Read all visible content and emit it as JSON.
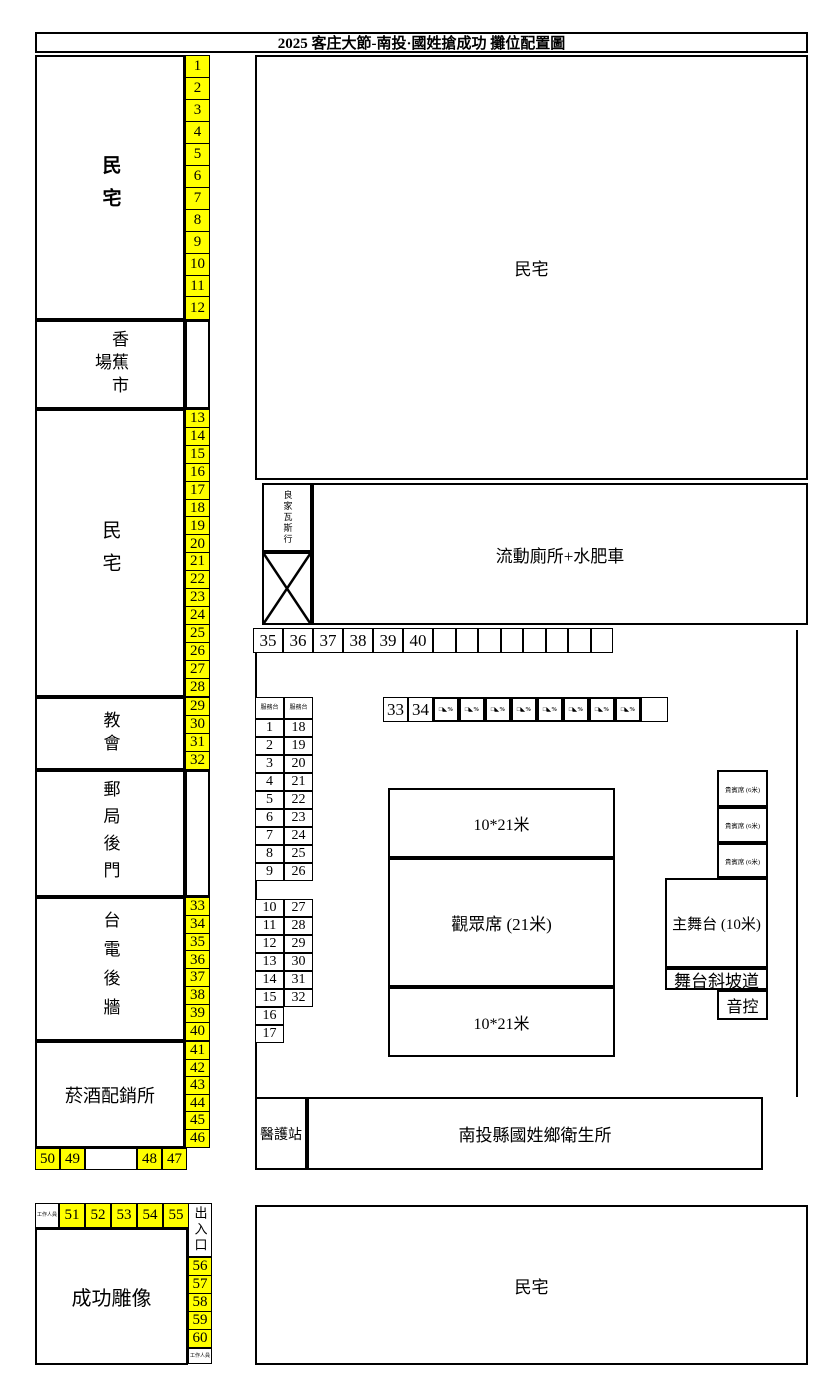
{
  "title": "2025 客庄大節-南投·國姓搶成功 攤位配置圖",
  "colors": {
    "booth_yellow": "#ffff00",
    "line_black": "#000000",
    "background": "#ffffff"
  },
  "areas": {
    "house_top_left": "民宅",
    "banana_market": "香蕉市場",
    "house_mid_left": "民宅",
    "church": "教會",
    "post_office_back": "郵局後門",
    "taipower_wall": "台電後牆",
    "tobacco_liquor": "菸酒配銷所",
    "chenggong_statue": "成功雕像",
    "staff": "工作人員",
    "entrance_exit": "出入口",
    "house_top_right": "民宅",
    "gas_shop": "良家瓦斯行",
    "mobile_toilets": "流動廁所+水肥車",
    "zone_top": "10*21米",
    "audience": "觀眾席 (21米)",
    "zone_bottom": "10*21米",
    "vip_seat": "貴賓席 (6米)",
    "main_stage": "主舞台 (10米)",
    "stage_ramp": "舞台斜坡道",
    "sound_control": "音控",
    "medical_station": "醫護站",
    "health_center": "南投縣國姓鄉衛生所",
    "house_bottom_right": "民宅"
  },
  "booths": {
    "strip_1_12": [
      "1",
      "2",
      "3",
      "4",
      "5",
      "6",
      "7",
      "8",
      "9",
      "10",
      "11",
      "12"
    ],
    "strip_13_28": [
      "13",
      "14",
      "15",
      "16",
      "17",
      "18",
      "19",
      "20",
      "21",
      "22",
      "23",
      "24",
      "25",
      "26",
      "27",
      "28"
    ],
    "strip_29_32": [
      "29",
      "30",
      "31",
      "32"
    ],
    "strip_33_40": [
      "33",
      "34",
      "35",
      "36",
      "37",
      "38",
      "39",
      "40"
    ],
    "strip_41_46": [
      "41",
      "42",
      "43",
      "44",
      "45",
      "46"
    ],
    "row_47_50": [
      "50",
      "49",
      "48",
      "47"
    ],
    "row_51_55": [
      "51",
      "52",
      "53",
      "54",
      "55"
    ],
    "strip_56_60": [
      "56",
      "57",
      "58",
      "59",
      "60"
    ],
    "street_row_numbers": [
      "35",
      "36",
      "37",
      "38",
      "39",
      "40"
    ],
    "street_row_empties": [
      "",
      "",
      "",
      "",
      "",
      "",
      "",
      ""
    ],
    "front_row_numbers": [
      "33",
      "34"
    ],
    "front_row_stamps": [
      "□◣%",
      "□◣%",
      "□◣%",
      "□◣%",
      "□◣%",
      "□◣%",
      "□◣%",
      "□◣%"
    ]
  },
  "service_desk": {
    "header": [
      "服務台",
      "服務台"
    ],
    "rows_a": [
      [
        "1",
        "18"
      ],
      [
        "2",
        "19"
      ],
      [
        "3",
        "20"
      ],
      [
        "4",
        "21"
      ],
      [
        "5",
        "22"
      ],
      [
        "6",
        "23"
      ],
      [
        "7",
        "24"
      ],
      [
        "8",
        "25"
      ],
      [
        "9",
        "26"
      ]
    ],
    "rows_b": [
      [
        "10",
        "27"
      ],
      [
        "11",
        "28"
      ],
      [
        "12",
        "29"
      ],
      [
        "13",
        "30"
      ],
      [
        "14",
        "31"
      ],
      [
        "15",
        "32"
      ]
    ],
    "rows_single": [
      "16",
      "17"
    ]
  }
}
